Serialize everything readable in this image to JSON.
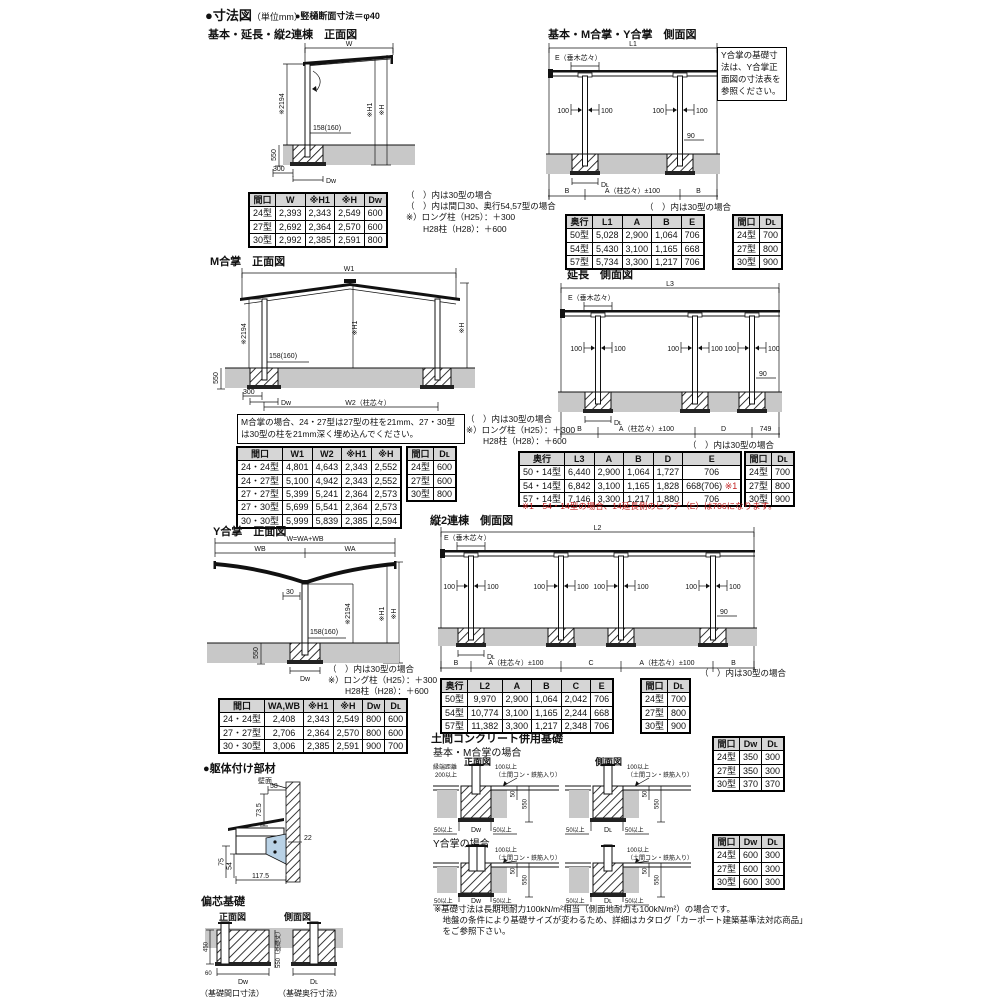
{
  "header": {
    "title": "●寸法図",
    "unit": "（単位mm）",
    "pipe_note": "●竪樋断面寸法＝φ40"
  },
  "front_basic": {
    "title": "基本・延長・縦2連棟　正面図",
    "dims": {
      "w": "W",
      "h2194": "※2194",
      "post": "158(160)",
      "d550": "550",
      "d300": "300",
      "dw": "Dᴡ",
      "h1": "※H1",
      "h": "※H"
    },
    "notes": [
      "（　）内は30型の場合",
      "（　）内は間口30、奥行54,57型の場合",
      "※）ロング柱（H25）：＋300",
      "　　H28柱（H28）：＋600"
    ],
    "table": {
      "headers": [
        "間口",
        "W",
        "※H1",
        "※H",
        "Dᴡ"
      ],
      "rows": [
        [
          "24型",
          "2,393",
          "2,343",
          "2,549",
          "600"
        ],
        [
          "27型",
          "2,692",
          "2,364",
          "2,570",
          "600"
        ],
        [
          "30型",
          "2,992",
          "2,385",
          "2,591",
          "800"
        ]
      ]
    }
  },
  "side_basic": {
    "title": "基本・M合掌・Y合掌　側面図",
    "dims": {
      "top": "L1",
      "e": "E（垂木芯々）",
      "p100": "100",
      "d90": "90",
      "dl": "Dʟ"
    },
    "segs": [
      "B",
      "A（柱芯々）±100",
      "B"
    ],
    "note_box": "Y合掌の基礎寸法は、Y合掌正面図の寸法表を参照ください。",
    "note": "（　）内は30型の場合",
    "table": {
      "headers": [
        "奥行",
        "L1",
        "A",
        "B",
        "E"
      ],
      "rows": [
        [
          "50型",
          "5,028",
          "2,900",
          "1,064",
          "706"
        ],
        [
          "54型",
          "5,430",
          "3,100",
          "1,165",
          "668"
        ],
        [
          "57型",
          "5,734",
          "3,300",
          "1,217",
          "706"
        ]
      ]
    },
    "dl_table": {
      "headers": [
        "間口",
        "Dʟ"
      ],
      "rows": [
        [
          "24型",
          "700"
        ],
        [
          "27型",
          "800"
        ],
        [
          "30型",
          "900"
        ]
      ]
    }
  },
  "front_m": {
    "title": "M合掌　正面図",
    "dims": {
      "w1": "W1",
      "w2": "W2（柱芯々）",
      "h2194": "※2194",
      "post": "158(160)",
      "d550": "550",
      "d300": "300",
      "dw": "Dᴡ",
      "h1": "※H1",
      "h": "※H"
    },
    "note_box": "M合掌の場合、24・27型は27型の柱を21mm、27・30型は30型の柱を21mm深く埋め込んでください。",
    "notes": [
      "（　）内は30型の場合",
      "※）ロング柱（H25）：＋300",
      "　　H28柱（H28）：＋600"
    ],
    "table": {
      "headers": [
        "間口",
        "W1",
        "W2",
        "※H1",
        "※H"
      ],
      "rows": [
        [
          "24・24型",
          "4,801",
          "4,643",
          "2,343",
          "2,552"
        ],
        [
          "24・27型",
          "5,100",
          "4,942",
          "2,343",
          "2,552"
        ],
        [
          "27・27型",
          "5,399",
          "5,241",
          "2,364",
          "2,573"
        ],
        [
          "27・30型",
          "5,699",
          "5,541",
          "2,364",
          "2,573"
        ],
        [
          "30・30型",
          "5,999",
          "5,839",
          "2,385",
          "2,594"
        ]
      ]
    },
    "dl_table": {
      "headers": [
        "間口",
        "Dʟ"
      ],
      "rows": [
        [
          "24型",
          "600"
        ],
        [
          "27型",
          "600"
        ],
        [
          "30型",
          "800"
        ]
      ]
    }
  },
  "side_ext": {
    "title": "延長　側面図",
    "dims": {
      "top": "L3",
      "e": "E（垂木芯々）",
      "p100": "100",
      "d90": "90",
      "dl": "Dʟ"
    },
    "segs": [
      "B",
      "A（柱芯々）±100",
      "D",
      "749"
    ],
    "note": "（　）内は30型の場合",
    "table": {
      "headers": [
        "奥行",
        "L3",
        "A",
        "B",
        "D",
        "E"
      ],
      "rows": [
        [
          "50・14型",
          "6,440",
          "2,900",
          "1,064",
          "1,727",
          "706"
        ],
        [
          "54・14型",
          "6,842",
          "3,100",
          "1,165",
          "1,828",
          "668(706) ※1"
        ],
        [
          "57・14型",
          "7,146",
          "3,300",
          "1,217",
          "1,880",
          "706"
        ]
      ]
    },
    "dl_table": {
      "headers": [
        "間口",
        "Dʟ"
      ],
      "rows": [
        [
          "24型",
          "700"
        ],
        [
          "27型",
          "800"
        ],
        [
          "30型",
          "900"
        ]
      ]
    },
    "red_note": "※1　54・14型の場合、14延長側のピッチ（E）は706になります。"
  },
  "front_y": {
    "title": "Y合掌　正面図",
    "dims": {
      "w": "W=WA+WB",
      "wb": "WB",
      "wa": "WA",
      "d30": "30",
      "h2194": "※2194",
      "post": "158(160)",
      "d550": "550",
      "dw": "Dᴡ",
      "h1": "※H1",
      "h": "※H"
    },
    "notes": [
      "（　）内は30型の場合",
      "※）ロング柱（H25）：＋300",
      "　　H28柱（H28）：＋600"
    ],
    "table": {
      "headers": [
        "間口",
        "WA,WB",
        "※H1",
        "※H",
        "Dᴡ",
        "Dʟ"
      ],
      "rows": [
        [
          "24・24型",
          "2,408",
          "2,343",
          "2,549",
          "800",
          "600"
        ],
        [
          "27・27型",
          "2,706",
          "2,364",
          "2,570",
          "800",
          "600"
        ],
        [
          "30・30型",
          "3,006",
          "2,385",
          "2,591",
          "900",
          "700"
        ]
      ]
    }
  },
  "side_tandem": {
    "title": "縦2連棟　側面図",
    "dims": {
      "top": "L2",
      "e": "E（垂木芯々）",
      "p100": "100",
      "d90": "90",
      "dl": "Dʟ"
    },
    "segs": [
      "B",
      "A（柱芯々）±100",
      "C",
      "A（柱芯々）±100",
      "B"
    ],
    "note": "（　）内は30型の場合",
    "table": {
      "headers": [
        "奥行",
        "L2",
        "A",
        "B",
        "C",
        "E"
      ],
      "rows": [
        [
          "50型",
          "9,970",
          "2,900",
          "1,064",
          "2,042",
          "706"
        ],
        [
          "54型",
          "10,774",
          "3,100",
          "1,165",
          "2,244",
          "668"
        ],
        [
          "57型",
          "11,382",
          "3,300",
          "1,217",
          "2,348",
          "706"
        ]
      ]
    },
    "dl_table": {
      "headers": [
        "間口",
        "Dʟ"
      ],
      "rows": [
        [
          "24型",
          "700"
        ],
        [
          "27型",
          "800"
        ],
        [
          "30型",
          "900"
        ]
      ]
    }
  },
  "bracket": {
    "title": "●躯体付け部材",
    "dims": {
      "wall": "壁面",
      "d58": "58",
      "d735": "73.5",
      "d22": "22",
      "d75": "75",
      "d54": "54",
      "d1175": "117.5"
    }
  },
  "eccentric": {
    "title": "偏芯基礎",
    "front_label": "正面図",
    "side_label": "側面図",
    "dims": {
      "d450": "450",
      "d60": "60",
      "dw": "Dᴡ",
      "d550": "550（基礎丈）",
      "dl": "Dʟ"
    },
    "front_caption": "（基礎間口寸法）",
    "side_caption": "（基礎奥行寸法）"
  },
  "doma": {
    "title": "土間コンクリート併用基礎",
    "case1": "基本・M合掌の場合",
    "case2": "Y合掌の場合",
    "front_label": "正面図",
    "side_label": "側面図",
    "dims": {
      "edge1": "縁端距離",
      "edge2": "200以上",
      "over100": "100以上",
      "rebar": "（土間コン・鉄筋入り）",
      "d50": "50",
      "d550": "550",
      "over50": "50以上",
      "dw": "Dᴡ",
      "dl": "Dʟ"
    },
    "table1": {
      "headers": [
        "間口",
        "Dᴡ",
        "Dʟ"
      ],
      "rows": [
        [
          "24型",
          "350",
          "300"
        ],
        [
          "27型",
          "350",
          "300"
        ],
        [
          "30型",
          "370",
          "370"
        ]
      ]
    },
    "table2": {
      "headers": [
        "間口",
        "Dᴡ",
        "Dʟ"
      ],
      "rows": [
        [
          "24型",
          "600",
          "300"
        ],
        [
          "27型",
          "600",
          "300"
        ],
        [
          "30型",
          "600",
          "300"
        ]
      ]
    },
    "note_lines": [
      "※基礎寸法は長期地耐力100kN/m²相当（側面地耐力も100kN/m²）の場合です。",
      "　地盤の条件により基礎サイズが変わるため、詳細はカタログ「カーポート建築基準法対応商品」",
      "　をご参照下さい。"
    ]
  }
}
